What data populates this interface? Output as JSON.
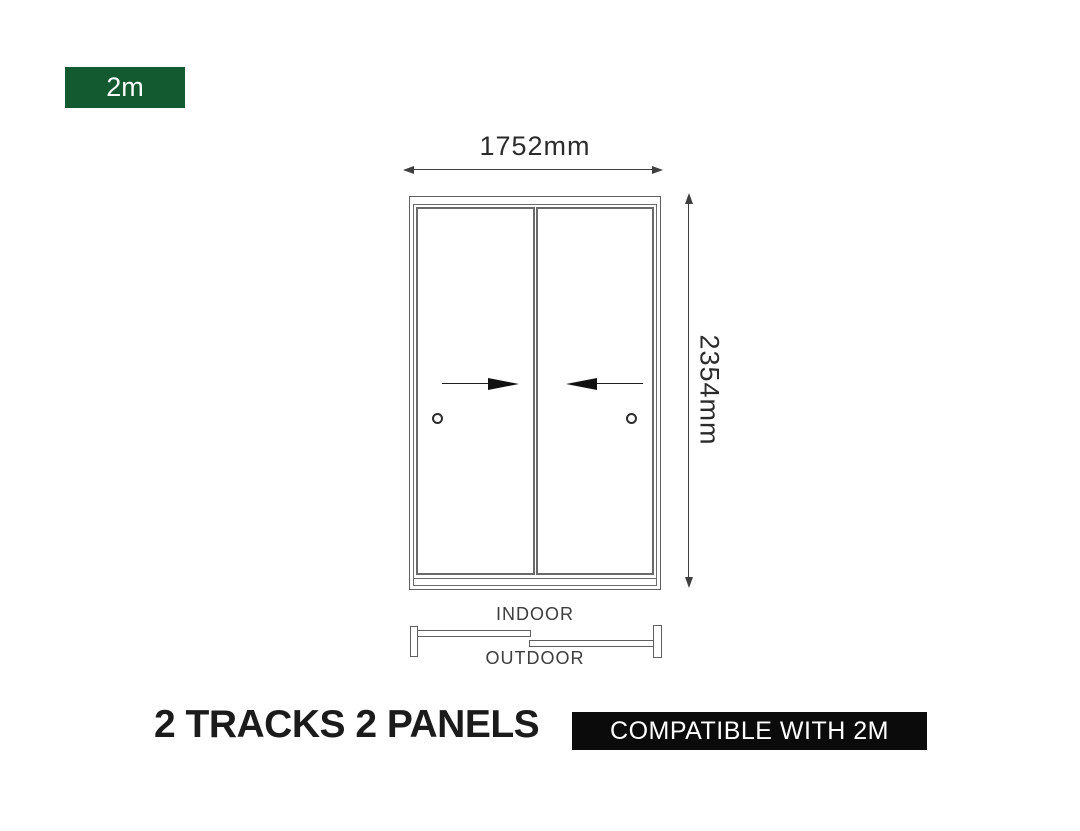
{
  "size_badge": {
    "label": "2m"
  },
  "front_view": {
    "width_label": "1752mm",
    "height_label": "2354mm",
    "panel_count": 2,
    "slide_direction": "both panels slide toward center"
  },
  "plan_view": {
    "indoor_label": "INDOOR",
    "outdoor_label": "OUTDOOR"
  },
  "footer": {
    "title": "2 TRACKS 2 PANELS",
    "compatibility": "COMPATIBLE WITH 2M"
  },
  "colors": {
    "badge_green": "#135a31",
    "badge_black": "#0b0b0b",
    "line_gray": "#6a6a6a",
    "frame_gray": "#5f5f5f",
    "dim_line": "#3f3f3f",
    "text_dark": "#1b1b1b",
    "dim_text": "#2b2b2b"
  }
}
